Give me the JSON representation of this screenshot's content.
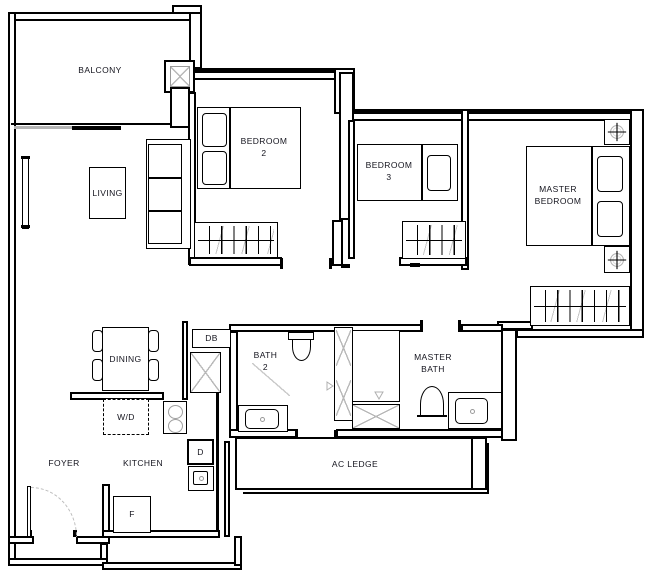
{
  "rooms": {
    "balcony": {
      "label": "BALCONY"
    },
    "living": {
      "label": "LIVING"
    },
    "bedroom2": {
      "line1": "BEDROOM",
      "line2": "2"
    },
    "bedroom3": {
      "line1": "BEDROOM",
      "line2": "3"
    },
    "master_bedroom": {
      "line1": "MASTER",
      "line2": "BEDROOM"
    },
    "dining": {
      "label": "DINING"
    },
    "bath2": {
      "line1": "BATH",
      "line2": "2"
    },
    "master_bath": {
      "line1": "MASTER",
      "line2": "BATH"
    },
    "foyer": {
      "label": "FOYER"
    },
    "kitchen": {
      "label": "KITCHEN"
    },
    "ac_ledge": {
      "label": "AC LEDGE"
    }
  },
  "appliances": {
    "db": {
      "label": "DB"
    },
    "washer_dryer": {
      "label": "W/D"
    },
    "d_unit": {
      "label": "D"
    },
    "fridge": {
      "label": "F"
    }
  },
  "symbols": {
    "balcony_column": "x-column",
    "duct_shaft": "x-cross-shaft",
    "bedside_lamp": "circle-cross-lamp",
    "shower_drain": "triangle-drain",
    "entry_door": "quarter-arc-door-swing",
    "wardrobe": "hatched-rail",
    "window": "double-line-pane"
  },
  "colors": {
    "wall": "#000000",
    "label_text": "#14141e",
    "hatch_gray": "#c6c6c6",
    "door_arc_gray": "#bdbdbd"
  }
}
